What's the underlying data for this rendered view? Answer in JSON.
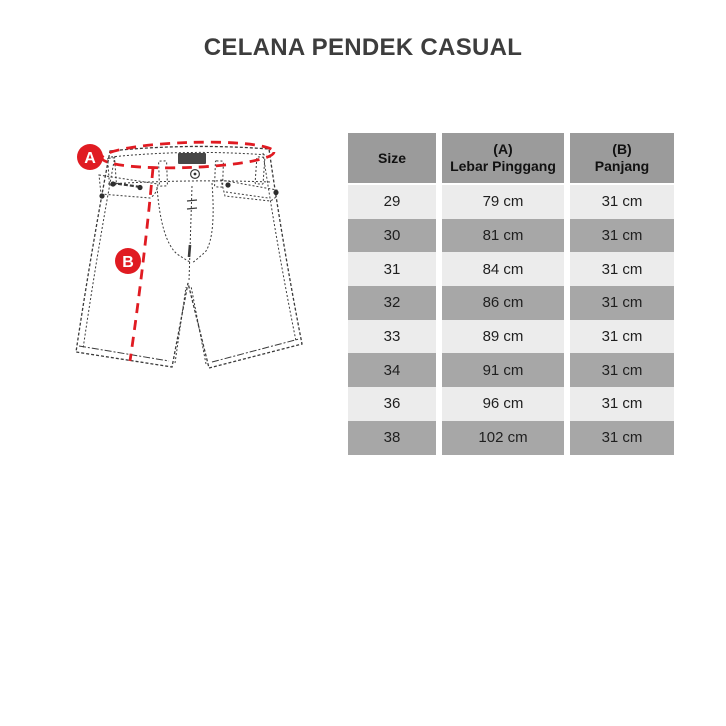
{
  "page": {
    "title": "CELANA PENDEK CASUAL",
    "background": "#ffffff"
  },
  "diagram": {
    "marker_a": "A",
    "marker_b": "B",
    "accent_color": "#e01b22",
    "sketch_color": "#3a3a3a",
    "patch_color": "#474747"
  },
  "size_table": {
    "header_bg": "#9b9b9b",
    "row_light_bg": "#ececec",
    "row_dark_bg": "#a7a7a7",
    "columns": [
      {
        "label": "Size"
      },
      {
        "top": "(A)",
        "bottom": "Lebar Pinggang"
      },
      {
        "top": "(B)",
        "bottom": "Panjang"
      }
    ],
    "rows": [
      {
        "size": "29",
        "waist": "79 cm",
        "length": "31 cm"
      },
      {
        "size": "30",
        "waist": "81 cm",
        "length": "31 cm"
      },
      {
        "size": "31",
        "waist": "84 cm",
        "length": "31 cm"
      },
      {
        "size": "32",
        "waist": "86 cm",
        "length": "31 cm"
      },
      {
        "size": "33",
        "waist": "89 cm",
        "length": "31 cm"
      },
      {
        "size": "34",
        "waist": "91 cm",
        "length": "31 cm"
      },
      {
        "size": "36",
        "waist": "96 cm",
        "length": "31 cm"
      },
      {
        "size": "38",
        "waist": "102 cm",
        "length": "31 cm"
      }
    ]
  }
}
